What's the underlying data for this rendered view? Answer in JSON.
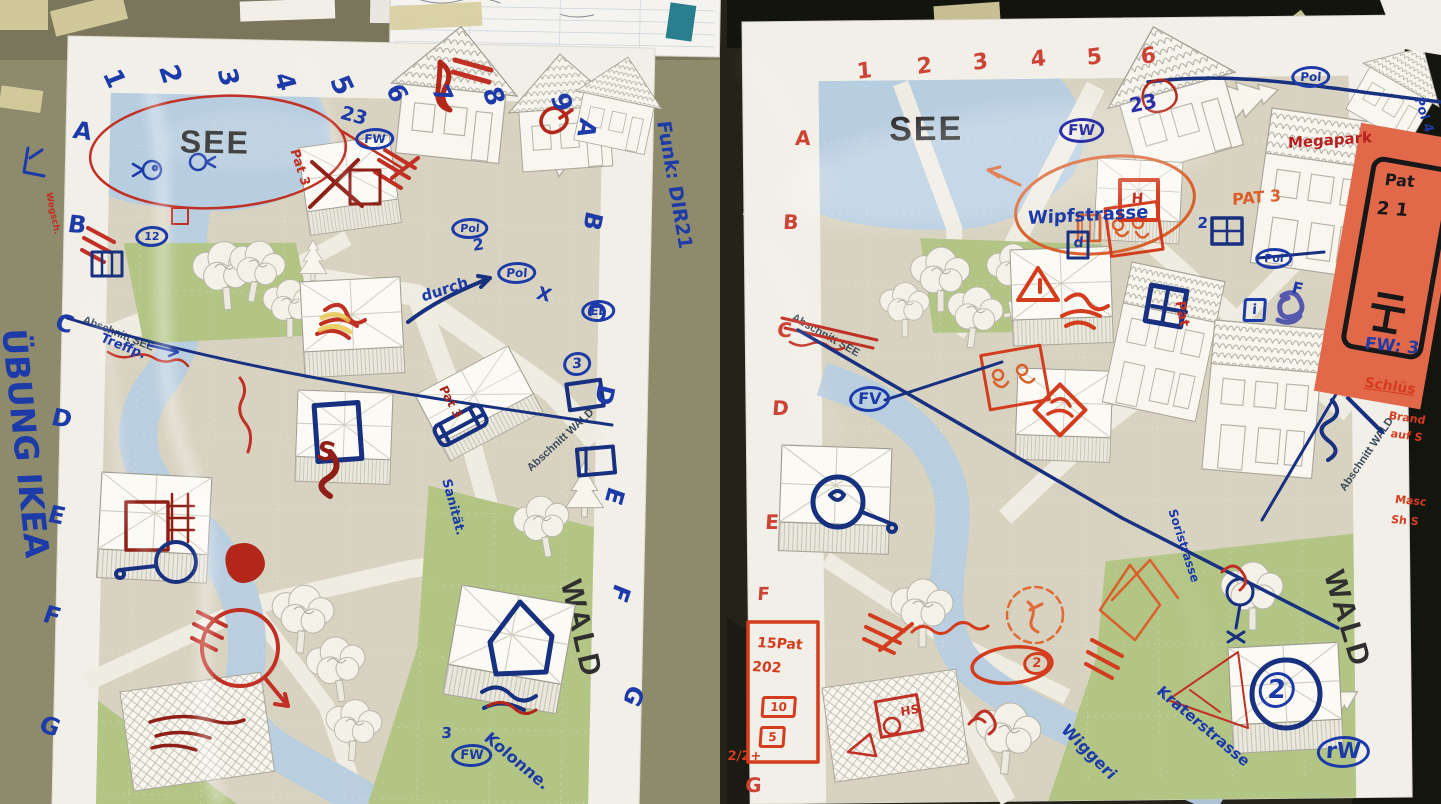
{
  "photo_title": "Tabletop exercise maps photograph",
  "colors": {
    "marker_blue": "#1c3aa8",
    "marker_navy": "#17307f",
    "marker_red": "#c03024",
    "marker_orange": "#d95f2b",
    "sticky_note": "#e2684a",
    "paper": "#f2efe8",
    "map_bg": "#d8d2c0",
    "water": "#b7cde0",
    "green": "#b2c585",
    "table_left": "#8e8a6c",
    "table_right": "#23231a"
  },
  "left_map": {
    "printed": {
      "lake": "SEE",
      "forest": "WALD",
      "section_see": "Abschnitt SEE",
      "section_wald": "Abschnitt WALD"
    },
    "annotations": [
      {
        "t": "1",
        "x": 122,
        "y": 66,
        "r": 65,
        "s": 26
      },
      {
        "t": "2",
        "x": 180,
        "y": 62,
        "r": 72,
        "s": 27
      },
      {
        "t": "3",
        "x": 238,
        "y": 66,
        "r": 75,
        "s": 26
      },
      {
        "t": "4",
        "x": 294,
        "y": 70,
        "r": 72,
        "s": 26
      },
      {
        "t": "5",
        "x": 350,
        "y": 72,
        "r": 65,
        "s": 27
      },
      {
        "t": "6",
        "x": 404,
        "y": 80,
        "r": 60,
        "s": 25
      },
      {
        "t": "7",
        "x": 450,
        "y": 82,
        "r": 65,
        "s": 24
      },
      {
        "t": "8",
        "x": 502,
        "y": 84,
        "r": 68,
        "s": 26
      },
      {
        "t": "9",
        "x": 570,
        "y": 90,
        "r": 68,
        "s": 26
      },
      {
        "t": "A",
        "x": 76,
        "y": 118,
        "r": 8,
        "s": 24
      },
      {
        "t": "B",
        "x": 70,
        "y": 212,
        "r": 5,
        "s": 24
      },
      {
        "t": "C",
        "x": 60,
        "y": 310,
        "r": 15,
        "s": 24
      },
      {
        "t": "D",
        "x": 55,
        "y": 405,
        "r": 10,
        "s": 24
      },
      {
        "t": "E",
        "x": 52,
        "y": 502,
        "r": 12,
        "s": 24
      },
      {
        "t": "F",
        "x": 48,
        "y": 602,
        "r": 15,
        "s": 24
      },
      {
        "t": "G",
        "x": 45,
        "y": 712,
        "r": 18,
        "s": 24
      },
      {
        "t": "A",
        "x": 600,
        "y": 122,
        "r": 100,
        "s": 24
      },
      {
        "t": "B",
        "x": 606,
        "y": 215,
        "r": 100,
        "s": 24
      },
      {
        "t": "C",
        "x": 610,
        "y": 305,
        "r": 102,
        "s": 24
      },
      {
        "t": "D",
        "x": 618,
        "y": 388,
        "r": 100,
        "s": 24
      },
      {
        "t": "E",
        "x": 628,
        "y": 492,
        "r": 105,
        "s": 24
      },
      {
        "t": "F",
        "x": 634,
        "y": 590,
        "r": 108,
        "s": 24
      },
      {
        "t": "G",
        "x": 648,
        "y": 692,
        "r": 112,
        "s": 24
      },
      {
        "t": "ÜBUNG IKEA",
        "x": 30,
        "y": 328,
        "r": 84,
        "s": 33
      },
      {
        "t": "Funk: DIR21",
        "x": 672,
        "y": 120,
        "r": 80,
        "s": 19
      },
      {
        "t": "23",
        "x": 344,
        "y": 104,
        "r": 15,
        "s": 19
      },
      {
        "t": "FW",
        "x": 356,
        "y": 128,
        "s": 12,
        "f": "circle"
      },
      {
        "t": "Treffp.",
        "x": 104,
        "y": 332,
        "r": 22,
        "s": 13
      },
      {
        "t": "Pat 3",
        "x": 300,
        "y": 148,
        "r": 72,
        "s": 13,
        "c": "#c03024"
      },
      {
        "t": "Pat 3",
        "x": 448,
        "y": 384,
        "r": 62,
        "s": 12,
        "c": "#a3241a"
      },
      {
        "t": "durch",
        "x": 420,
        "y": 290,
        "r": -18,
        "s": 15
      },
      {
        "t": "2",
        "x": 472,
        "y": 238,
        "r": -10,
        "s": 16
      },
      {
        "t": "Pol",
        "x": 498,
        "y": 262,
        "s": 12,
        "f": "circle"
      },
      {
        "t": "Pol",
        "x": 452,
        "y": 218,
        "s": 11,
        "f": "circle"
      },
      {
        "t": "X",
        "x": 540,
        "y": 285,
        "r": 15,
        "s": 18
      },
      {
        "t": "EL",
        "x": 582,
        "y": 300,
        "s": 12,
        "f": "circle"
      },
      {
        "t": "3",
        "x": 564,
        "y": 352,
        "s": 14,
        "f": "circle"
      },
      {
        "t": "Sanität.",
        "x": 452,
        "y": 478,
        "r": 75,
        "s": 13
      },
      {
        "t": "Kolonne.",
        "x": 492,
        "y": 730,
        "r": 40,
        "s": 16
      },
      {
        "t": "3",
        "x": 442,
        "y": 726,
        "s": 15
      },
      {
        "t": "FW",
        "x": 452,
        "y": 744,
        "s": 13,
        "f": "circle"
      },
      {
        "t": "Wegsch.",
        "x": 52,
        "y": 192,
        "r": 78,
        "s": 9,
        "c": "#c03024"
      },
      {
        "t": "12",
        "x": 136,
        "y": 226,
        "s": 11,
        "f": "circle"
      },
      {
        "t": "S",
        "x": 320,
        "y": 438,
        "r": 10,
        "s": 26,
        "c": "#8f1f16"
      }
    ]
  },
  "right_map": {
    "printed": {
      "lake": "SEE",
      "forest": "WALD",
      "section_see": "Abschnitt SEE",
      "section_wald": "Abschnitt WALD"
    },
    "annotations": [
      {
        "t": "1",
        "x": 856,
        "y": 62,
        "r": -8,
        "s": 22,
        "c": "#cc4436"
      },
      {
        "t": "2",
        "x": 916,
        "y": 57,
        "r": -8,
        "s": 22,
        "c": "#cc4436"
      },
      {
        "t": "3",
        "x": 972,
        "y": 53,
        "r": -8,
        "s": 22,
        "c": "#cc4436"
      },
      {
        "t": "4",
        "x": 1030,
        "y": 50,
        "r": -8,
        "s": 22,
        "c": "#cc4436"
      },
      {
        "t": "5",
        "x": 1086,
        "y": 48,
        "r": -8,
        "s": 22,
        "c": "#cc4436"
      },
      {
        "t": "6",
        "x": 1140,
        "y": 47,
        "r": -8,
        "s": 22,
        "c": "#cc4436"
      },
      {
        "t": "A",
        "x": 796,
        "y": 128,
        "s": 20,
        "c": "#cc4436"
      },
      {
        "t": "B",
        "x": 784,
        "y": 212,
        "s": 20,
        "c": "#cc4436"
      },
      {
        "t": "C",
        "x": 778,
        "y": 320,
        "s": 20,
        "c": "#cc4436"
      },
      {
        "t": "D",
        "x": 773,
        "y": 398,
        "s": 20,
        "c": "#cc4436"
      },
      {
        "t": "E",
        "x": 766,
        "y": 512,
        "s": 20,
        "c": "#cc4436"
      },
      {
        "t": "F",
        "x": 758,
        "y": 586,
        "s": 18,
        "c": "#cc4436"
      },
      {
        "t": "G",
        "x": 746,
        "y": 775,
        "s": 20,
        "c": "#cc4436"
      },
      {
        "t": "FW",
        "x": 1060,
        "y": 118,
        "s": 15,
        "f": "circle",
        "c": "#2b2fa8"
      },
      {
        "t": "23",
        "x": 1128,
        "y": 96,
        "r": -12,
        "s": 20,
        "c": "#2b2fa8"
      },
      {
        "t": "Wipfstrasse",
        "x": 1028,
        "y": 210,
        "r": -3,
        "s": 18
      },
      {
        "t": "d",
        "x": 1074,
        "y": 236,
        "s": 14
      },
      {
        "t": "PAT 3",
        "x": 1232,
        "y": 192,
        "r": -5,
        "s": 16,
        "c": "#d95f2b"
      },
      {
        "t": "FV",
        "x": 850,
        "y": 386,
        "s": 16,
        "f": "circle"
      },
      {
        "t": "Pat",
        "x": 1186,
        "y": 300,
        "r": 78,
        "s": 14,
        "c": "#c03024"
      },
      {
        "t": "Megapark",
        "x": 1288,
        "y": 136,
        "r": -4,
        "s": 15,
        "c": "#b82020"
      },
      {
        "t": "Pat",
        "x": 1386,
        "y": 172,
        "r": 4,
        "s": 16,
        "c": "#181818"
      },
      {
        "t": "2 1",
        "x": 1378,
        "y": 200,
        "r": 4,
        "s": 18,
        "c": "#181818"
      },
      {
        "t": "Pol",
        "x": 1292,
        "y": 66,
        "s": 12,
        "f": "circle"
      },
      {
        "t": "Pol",
        "x": 1256,
        "y": 248,
        "s": 11,
        "f": "circle"
      },
      {
        "t": "F",
        "x": 1294,
        "y": 280,
        "r": 10,
        "s": 16
      },
      {
        "t": "i",
        "x": 1244,
        "y": 298,
        "s": 14,
        "f": "box"
      },
      {
        "t": "2",
        "x": 1198,
        "y": 216,
        "s": 15
      },
      {
        "t": "Pol 4",
        "x": 1424,
        "y": 96,
        "r": 72,
        "s": 13
      },
      {
        "t": "H",
        "x": 1132,
        "y": 192,
        "s": 14,
        "c": "#c03024"
      },
      {
        "t": "HS",
        "x": 900,
        "y": 706,
        "r": -10,
        "s": 12,
        "c": "#c03024"
      },
      {
        "t": "15Pat",
        "x": 758,
        "y": 636,
        "r": 3,
        "s": 14,
        "c": "#d43c1e"
      },
      {
        "t": "202",
        "x": 753,
        "y": 660,
        "r": 3,
        "s": 14,
        "c": "#d43c1e"
      },
      {
        "t": "10",
        "x": 762,
        "y": 696,
        "s": 12,
        "f": "box",
        "c": "#d43c1e"
      },
      {
        "t": "5",
        "x": 760,
        "y": 726,
        "s": 12,
        "f": "box",
        "c": "#d43c1e"
      },
      {
        "t": "2/2+",
        "x": 728,
        "y": 750,
        "s": 13,
        "c": "#d43c1e"
      },
      {
        "t": "2",
        "x": 1024,
        "y": 652,
        "s": 13,
        "f": "circle",
        "c": "#d43c1e"
      },
      {
        "t": "Kraterstrasse",
        "x": 1164,
        "y": 684,
        "r": 40,
        "s": 15
      },
      {
        "t": "rW",
        "x": 1318,
        "y": 736,
        "s": 22,
        "f": "circle"
      },
      {
        "t": "Wiggeri",
        "x": 1070,
        "y": 722,
        "r": 45,
        "s": 16
      },
      {
        "t": "Soristrasse",
        "x": 1178,
        "y": 508,
        "r": 72,
        "s": 12
      },
      {
        "t": "FW: 3",
        "x": 1366,
        "y": 336,
        "r": 5,
        "s": 17
      },
      {
        "t": "Schlüs",
        "x": 1366,
        "y": 376,
        "r": 8,
        "s": 14,
        "c": "#d43c1e",
        "u": 1
      },
      {
        "t": "Brand",
        "x": 1390,
        "y": 410,
        "r": 8,
        "s": 11,
        "c": "#d43c1e"
      },
      {
        "t": "auf S",
        "x": 1392,
        "y": 428,
        "r": 8,
        "s": 11,
        "c": "#d43c1e"
      },
      {
        "t": "Masc",
        "x": 1396,
        "y": 494,
        "r": 5,
        "s": 11,
        "c": "#d43c1e"
      },
      {
        "t": "Sh S",
        "x": 1392,
        "y": 514,
        "r": 5,
        "s": 11,
        "c": "#d43c1e"
      },
      {
        "t": "2",
        "x": 1260,
        "y": 672,
        "s": 26,
        "f": "circle"
      }
    ]
  }
}
